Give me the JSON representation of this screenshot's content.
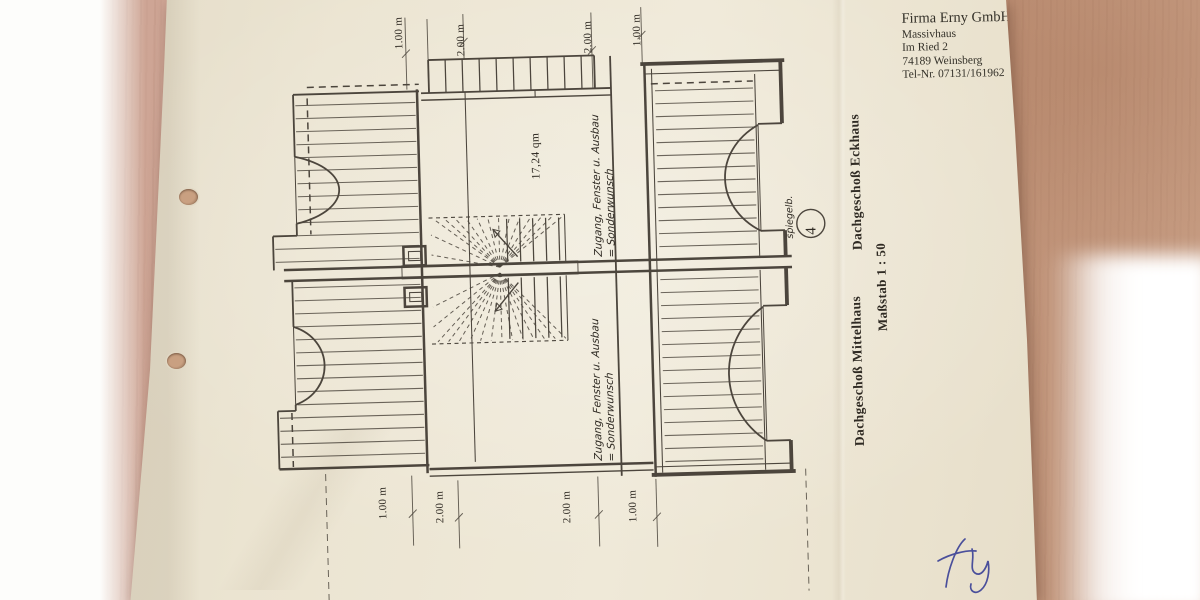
{
  "title_block": {
    "line1": "Firma Erny GmbH",
    "line2": "Massivhaus",
    "line3": "Im Ried 2",
    "line4": "74189 Weinsberg",
    "line5": "Tel-Nr. 07131/161962"
  },
  "labels": {
    "unit_right_top": "Dachgeschoß Eckhaus",
    "unit_right_bottom": "Dachgeschoß Mittelhaus",
    "scale": "Maßstab 1 : 50",
    "area": "17,24 qm",
    "mirror_abbrev": "spiegelb.",
    "detail_circle_number": "4",
    "note_top_line1": "Zugang, Fenster u. Ausbau",
    "note_top_line2": "= Sonderwunsch",
    "note_bottom_line1": "Zugang, Fenster u. Ausbau",
    "note_bottom_line2": "= Sonderwunsch"
  },
  "dimensions": {
    "top": [
      "1.00 m",
      "2.00 m",
      "2.00 m",
      "1.00 m"
    ],
    "bottom": [
      "1.00 m",
      "2.00 m",
      "2.00 m",
      "1.00 m"
    ]
  },
  "colors": {
    "paper": "#ebe4d1",
    "ink": "#3a342c",
    "ink_text": "#2f2a23",
    "wood_left": "#cfa796",
    "wood_right": "#bd8f74",
    "signature": "#4a4f9b"
  }
}
